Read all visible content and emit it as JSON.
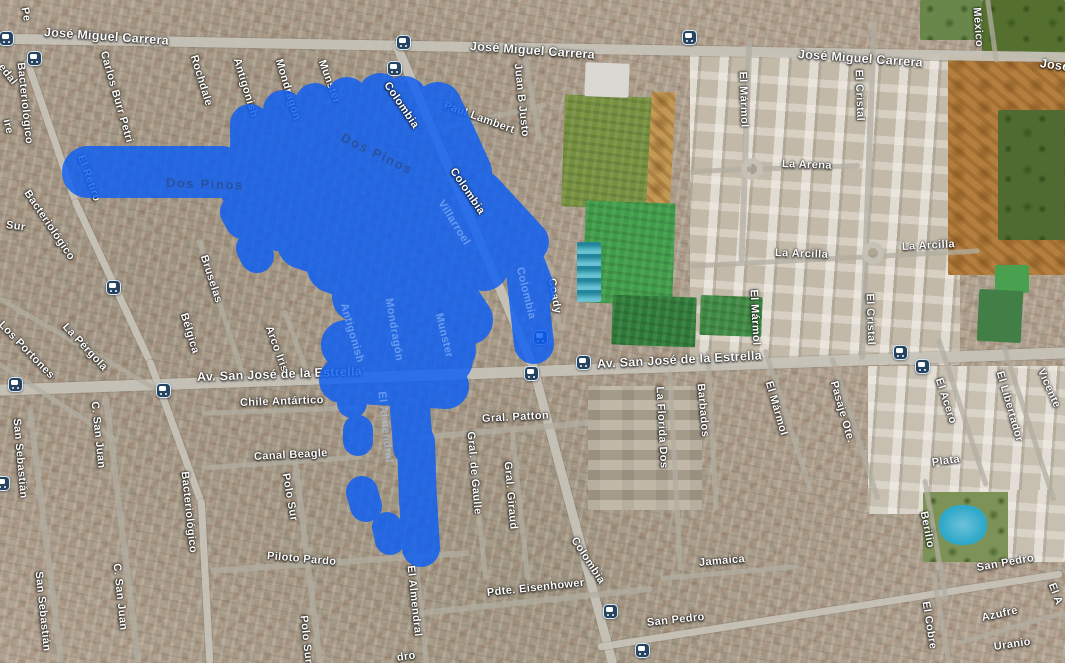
{
  "map": {
    "annotation": {
      "color": "#0b5ef5",
      "opacity": 0.82,
      "strokes": [
        [
          52,
          88,
          172,
          222,
          172
        ],
        [
          40,
          250,
          124,
          250,
          162
        ],
        [
          40,
          283,
          110,
          283,
          178
        ],
        [
          40,
          315,
          103,
          315,
          195
        ],
        [
          42,
          347,
          98,
          350,
          215
        ],
        [
          44,
          380,
          95,
          383,
          230
        ],
        [
          48,
          404,
          100,
          442,
          152
        ],
        [
          48,
          438,
          106,
          468,
          172
        ],
        [
          55,
          258,
          152,
          430,
          196
        ],
        [
          55,
          247,
          187,
          438,
          230
        ],
        [
          55,
          272,
          222,
          432,
          256
        ],
        [
          52,
          303,
          243,
          422,
          282
        ],
        [
          52,
          333,
          267,
          428,
          302
        ],
        [
          50,
          357,
          297,
          430,
          330
        ],
        [
          55,
          392,
          122,
          468,
          198
        ],
        [
          55,
          420,
          132,
          488,
          222
        ],
        [
          52,
          436,
          162,
          498,
          252
        ],
        [
          50,
          446,
          207,
          484,
          266
        ],
        [
          50,
          426,
          256,
          468,
          320
        ],
        [
          48,
          416,
          300,
          452,
          350
        ],
        [
          42,
          482,
          192,
          528,
          242
        ],
        [
          42,
          512,
          232,
          534,
          290
        ],
        [
          40,
          526,
          272,
          534,
          344
        ],
        [
          50,
          346,
          345,
          448,
          360
        ],
        [
          46,
          342,
          380,
          446,
          386
        ],
        [
          40,
          420,
          342,
          409,
          396
        ],
        [
          40,
          409,
          396,
          413,
          447
        ],
        [
          38,
          416,
          442,
          418,
          502
        ],
        [
          38,
          418,
          498,
          421,
          548
        ],
        [
          32,
          371,
          352,
          368,
          368
        ],
        [
          30,
          352,
          392,
          352,
          403
        ],
        [
          30,
          358,
          430,
          358,
          441
        ],
        [
          32,
          362,
          492,
          366,
          506
        ],
        [
          30,
          387,
          527,
          390,
          540
        ],
        [
          36,
          238,
          212,
          243,
          221
        ],
        [
          34,
          253,
          248,
          257,
          256
        ]
      ]
    },
    "labels": [
      [
        "Pe",
        24,
        2,
        80,
        "w"
      ],
      [
        "ire",
        6,
        114,
        78,
        "w"
      ],
      [
        "edal",
        0,
        60,
        52,
        "w"
      ],
      [
        "Bacteriológico",
        20,
        57,
        84,
        "w"
      ],
      [
        "José Miguel Carrera",
        44,
        26,
        4,
        "rd"
      ],
      [
        "José Miguel Carrera",
        470,
        40,
        4,
        "rd"
      ],
      [
        "José Miguel Carrera",
        798,
        48,
        4,
        "rd"
      ],
      [
        "José",
        1040,
        57,
        8,
        "rd"
      ],
      [
        "México",
        976,
        2,
        86,
        "w"
      ],
      [
        "Carlos Burr Petri",
        103,
        46,
        74,
        "w"
      ],
      [
        "El Retiro",
        80,
        150,
        70,
        "w"
      ],
      [
        "Rochdale",
        193,
        50,
        73,
        "w"
      ],
      [
        "Antigonish",
        236,
        53,
        73,
        "w"
      ],
      [
        "Mondragón",
        278,
        54,
        73,
        "w"
      ],
      [
        "Munster",
        321,
        55,
        70,
        "w"
      ],
      [
        "Colombia",
        386,
        78,
        56,
        "wt"
      ],
      [
        "Paul Lambert",
        444,
        100,
        20,
        "w"
      ],
      [
        "Juan B Justo",
        517,
        58,
        84,
        "w"
      ],
      [
        "Dos Pinos",
        342,
        130,
        26,
        "md"
      ],
      [
        "Dos Pinos",
        166,
        176,
        2,
        "md"
      ],
      [
        "El Mármol",
        742,
        66,
        88,
        "w"
      ],
      [
        "El Cristal",
        858,
        64,
        88,
        "w"
      ],
      [
        "La Arena",
        782,
        159,
        2,
        "w"
      ],
      [
        "La Arcilla",
        775,
        248,
        2,
        "w"
      ],
      [
        "La Arcilla",
        902,
        242,
        -3,
        "w"
      ],
      [
        "El Mármol",
        753,
        284,
        87,
        "w"
      ],
      [
        "El Cristal",
        869,
        288,
        88,
        "w"
      ],
      [
        "Coady",
        551,
        273,
        80,
        "w"
      ],
      [
        "Colombia",
        452,
        164,
        56,
        "wt"
      ],
      [
        "Villarroel",
        440,
        196,
        58,
        "ml"
      ],
      [
        "Colombia",
        519,
        262,
        76,
        "ml"
      ],
      [
        "Mondragón",
        388,
        293,
        80,
        "ml"
      ],
      [
        "Munster",
        438,
        308,
        76,
        "ml"
      ],
      [
        "Antigonish",
        343,
        298,
        74,
        "ml"
      ],
      [
        "El Almendral",
        381,
        386,
        84,
        "ml"
      ],
      [
        "Bruselas",
        203,
        250,
        72,
        "w"
      ],
      [
        "Bélgica",
        183,
        308,
        73,
        "w"
      ],
      [
        "Arco Iris",
        268,
        321,
        70,
        "w"
      ],
      [
        "Los Portones",
        0,
        318,
        46,
        "w"
      ],
      [
        "La Pérgola",
        64,
        320,
        47,
        "w"
      ],
      [
        "Bacteriológico",
        26,
        186,
        56,
        "w"
      ],
      [
        "Sur",
        6,
        220,
        8,
        "w"
      ],
      [
        "Av. San José de la Estrella",
        197,
        371,
        -2,
        "rd"
      ],
      [
        "Av. San José de la Estrella",
        597,
        358,
        -3,
        "rd"
      ],
      [
        "Chile Antártico",
        240,
        398,
        -2,
        "w"
      ],
      [
        "Canal Beagle",
        254,
        452,
        -3,
        "w"
      ],
      [
        "Gral. Patton",
        482,
        414,
        -3,
        "w"
      ],
      [
        "Gral. de Gaulle",
        470,
        426,
        85,
        "w"
      ],
      [
        "Gral. Giraud",
        507,
        456,
        85,
        "w"
      ],
      [
        "La Florida Dos",
        659,
        381,
        87,
        "w"
      ],
      [
        "Barbados",
        700,
        378,
        85,
        "w"
      ],
      [
        "El Mármol",
        768,
        376,
        74,
        "w"
      ],
      [
        "Pasaje Ote.",
        833,
        376,
        74,
        "w"
      ],
      [
        "El Acero",
        938,
        373,
        72,
        "w"
      ],
      [
        "El Libertador",
        999,
        366,
        74,
        "w"
      ],
      [
        "Vicente",
        1040,
        364,
        66,
        "w"
      ],
      [
        "Plata",
        932,
        458,
        -8,
        "w"
      ],
      [
        "C. San Juan",
        94,
        396,
        84,
        "w"
      ],
      [
        "Bacteriológico",
        184,
        466,
        84,
        "w"
      ],
      [
        "Polo Sur",
        285,
        468,
        80,
        "w"
      ],
      [
        "San Sebastián",
        16,
        413,
        85,
        "w"
      ],
      [
        "San Sebastián",
        38,
        566,
        84,
        "w"
      ],
      [
        "C. San Juan",
        116,
        558,
        84,
        "w"
      ],
      [
        "Piloto Pardo",
        267,
        551,
        5,
        "w"
      ],
      [
        "Polo Sur",
        303,
        610,
        84,
        "w"
      ],
      [
        "El Almendral",
        410,
        560,
        84,
        "w"
      ],
      [
        "Colombia",
        573,
        533,
        57,
        "w"
      ],
      [
        "Pdte. Eisenhower",
        487,
        588,
        -6,
        "w"
      ],
      [
        "San Pedro",
        647,
        618,
        -6,
        "w"
      ],
      [
        "Jamaica",
        699,
        558,
        -5,
        "w"
      ],
      [
        "Berilio",
        923,
        506,
        79,
        "w"
      ],
      [
        "San Pedro",
        977,
        563,
        -10,
        "w"
      ],
      [
        "El Cobre",
        925,
        596,
        81,
        "w"
      ],
      [
        "Azufre",
        982,
        613,
        -12,
        "w"
      ],
      [
        "Uranio",
        994,
        642,
        -8,
        "w"
      ],
      [
        "El A",
        1051,
        578,
        70,
        "w"
      ],
      [
        "dro",
        397,
        653,
        -8,
        "w"
      ]
    ],
    "bus_stops": [
      [
        6,
        38
      ],
      [
        34,
        58
      ],
      [
        403,
        42
      ],
      [
        394,
        68
      ],
      [
        689,
        37
      ],
      [
        113,
        287
      ],
      [
        15,
        384
      ],
      [
        163,
        390
      ],
      [
        531,
        373
      ],
      [
        583,
        362
      ],
      [
        540,
        337
      ],
      [
        900,
        352
      ],
      [
        922,
        366
      ],
      [
        610,
        611
      ],
      [
        642,
        650
      ],
      [
        2,
        483
      ]
    ],
    "roads": {
      "major": [
        [
          533,
          48,
          1080,
          10,
          1
        ],
        [
          533,
          371,
          1080,
          11,
          -2
        ],
        [
          466,
          208,
          360,
          9,
          67
        ],
        [
          573,
          517,
          305,
          9,
          75
        ],
        [
          51,
          130,
          150,
          7,
          71
        ],
        [
          112,
          280,
          178,
          7,
          65
        ],
        [
          175,
          430,
          150,
          7,
          70
        ],
        [
          205,
          581,
          165,
          7,
          87
        ],
        [
          830,
          610,
          470,
          7,
          -9
        ]
      ],
      "minor": [
        [
          45,
          536,
          255,
          6,
          83
        ],
        [
          122,
          529,
          270,
          6,
          83
        ],
        [
          307,
          561,
          205,
          6,
          83
        ],
        [
          340,
          562,
          260,
          6,
          -4
        ],
        [
          282,
          462,
          160,
          5,
          -4
        ],
        [
          282,
          410,
          160,
          5,
          -2
        ],
        [
          505,
          430,
          175,
          6,
          -5
        ],
        [
          535,
          601,
          235,
          6,
          -6
        ],
        [
          730,
          572,
          140,
          5,
          -5
        ],
        [
          222,
          310,
          150,
          5,
          72
        ],
        [
          297,
          345,
          76,
          5,
          70
        ],
        [
          80,
          345,
          185,
          5,
          30
        ],
        [
          55,
          400,
          150,
          5,
          33
        ],
        [
          532,
          97,
          88,
          5,
          80
        ],
        [
          490,
          117,
          115,
          5,
          -13
        ],
        [
          554,
          295,
          72,
          5,
          80
        ],
        [
          745,
          150,
          225,
          6,
          92
        ],
        [
          868,
          190,
          340,
          6,
          92
        ],
        [
          775,
          168,
          170,
          5,
          -2
        ],
        [
          835,
          258,
          290,
          5,
          -3
        ],
        [
          712,
          430,
          160,
          5,
          87
        ],
        [
          675,
          470,
          200,
          5,
          87
        ],
        [
          788,
          420,
          150,
          5,
          72
        ],
        [
          855,
          428,
          150,
          5,
          72
        ],
        [
          962,
          412,
          155,
          5,
          72
        ],
        [
          1028,
          422,
          165,
          5,
          72
        ],
        [
          935,
          540,
          125,
          5,
          80
        ],
        [
          941,
          620,
          95,
          5,
          80
        ],
        [
          1012,
          627,
          112,
          5,
          -16
        ],
        [
          992,
          30,
          64,
          5,
          82
        ],
        [
          478,
          505,
          150,
          5,
          84
        ],
        [
          520,
          505,
          150,
          5,
          84
        ],
        [
          420,
          600,
          130,
          5,
          84
        ]
      ],
      "roundabouts": [
        [
          741,
          158
        ],
        [
          862,
          242
        ]
      ]
    },
    "areas": [
      [
        690,
        55,
        270,
        310,
        "#c2b9a8",
        0,
        "blocks"
      ],
      [
        563,
        96,
        94,
        112,
        "#75903e",
        2,
        "grass"
      ],
      [
        646,
        92,
        24,
        225,
        "#c39a55",
        3,
        "dirt"
      ],
      [
        584,
        202,
        90,
        102,
        "#3f9c48",
        2,
        "grass"
      ],
      [
        612,
        296,
        84,
        50,
        "#2e7b38",
        2,
        "grass"
      ],
      [
        700,
        296,
        62,
        40,
        "#3e8a42",
        2,
        "grass"
      ],
      [
        948,
        55,
        117,
        220,
        "#b47f3e",
        0,
        "dirt"
      ],
      [
        998,
        110,
        67,
        130,
        "#506b31",
        0,
        "trees"
      ],
      [
        982,
        0,
        83,
        58,
        "#55702e",
        0,
        "trees"
      ],
      [
        920,
        0,
        62,
        40,
        "#6a874b",
        0,
        "trees"
      ],
      [
        995,
        265,
        34,
        28,
        "#49a04f",
        0,
        "plain"
      ],
      [
        978,
        290,
        44,
        52,
        "#417f47",
        3,
        "plain"
      ],
      [
        585,
        63,
        44,
        34,
        "#d9d8d3",
        2,
        "plain"
      ],
      [
        577,
        242,
        24,
        60,
        "#35aec5",
        0,
        "bleachers"
      ],
      [
        588,
        386,
        114,
        124,
        "#b5aa97",
        0,
        "school"
      ],
      [
        868,
        366,
        197,
        148,
        "#c7bfb0",
        0,
        "blocks"
      ],
      [
        923,
        492,
        94,
        70,
        "#7d9256",
        0,
        "trees"
      ],
      [
        939,
        505,
        48,
        40,
        "#2fa8ca",
        0,
        "pool"
      ],
      [
        1008,
        490,
        57,
        72,
        "#c7bfb0",
        0,
        "blocks"
      ]
    ]
  }
}
